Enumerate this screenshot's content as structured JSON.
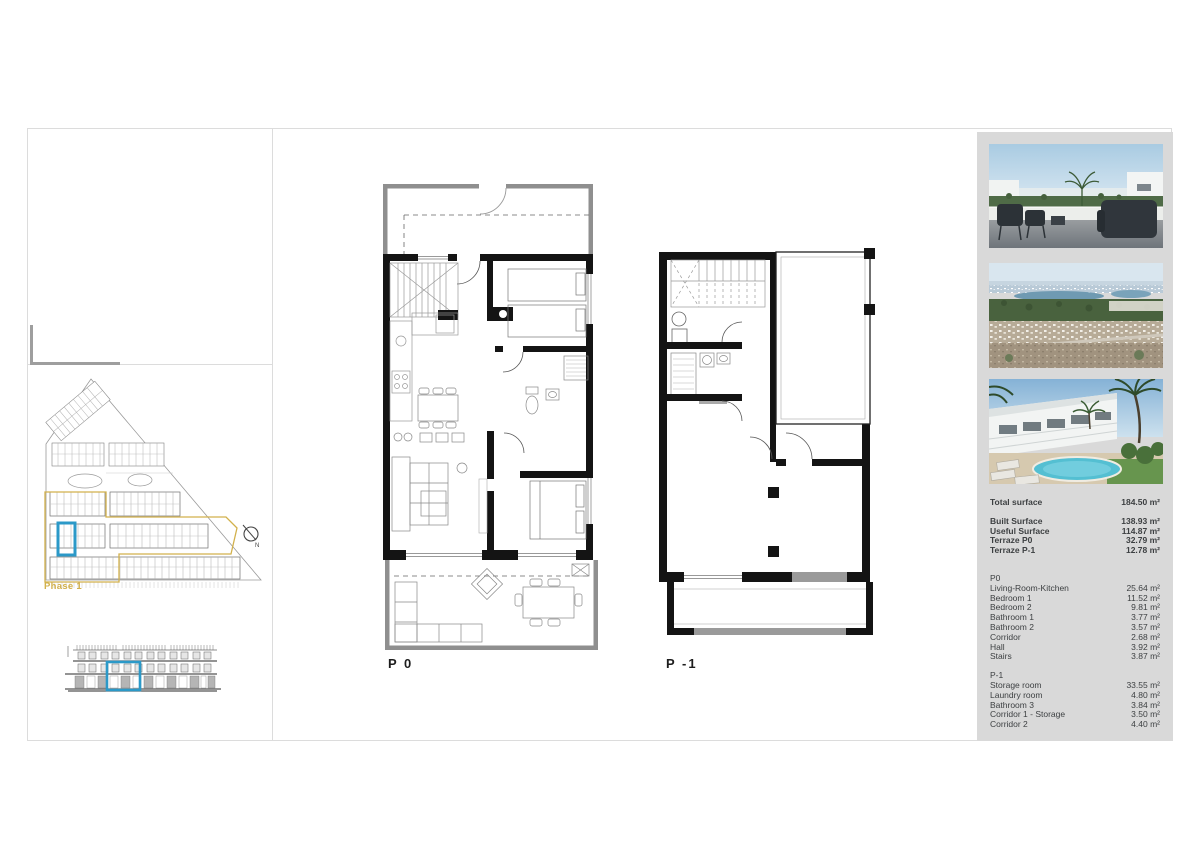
{
  "site_plan": {
    "phase_label": "Phase 1",
    "north_label": "N"
  },
  "floor_plans": {
    "p0_label": "P 0",
    "p1_label": "P -1"
  },
  "summary": {
    "total": {
      "label": "Total surface",
      "value": "184.50 m²"
    },
    "surfaces": [
      {
        "label": "Built Surface",
        "value": "138.93 m²"
      },
      {
        "label": "Useful Surface",
        "value": "114.87 m²"
      },
      {
        "label": "Terraze P0",
        "value": "32.79 m²"
      },
      {
        "label": "Terraze P-1",
        "value": "12.78 m²"
      }
    ],
    "p0_section": {
      "header": "P0",
      "rooms": [
        {
          "label": "Living-Room-Kitchen",
          "value": "25.64 m²"
        },
        {
          "label": "Bedroom 1",
          "value": "11.52 m²"
        },
        {
          "label": "Bedroom 2",
          "value": "9.81 m²"
        },
        {
          "label": "Bathroom 1",
          "value": "3.77 m²"
        },
        {
          "label": "Bathroom 2",
          "value": "3.57 m²"
        },
        {
          "label": "Corridor",
          "value": "2.68 m²"
        },
        {
          "label": "Hall",
          "value": "3.92 m²"
        },
        {
          "label": "Stairs",
          "value": "3.87 m²"
        }
      ]
    },
    "p1_section": {
      "header": "P-1",
      "rooms": [
        {
          "label": "Storage room",
          "value": "33.55 m²"
        },
        {
          "label": "Laundry room",
          "value": "4.80 m²"
        },
        {
          "label": "Bathroom 3",
          "value": "3.84 m²"
        },
        {
          "label": "Corridor 1 - Storage",
          "value": "3.50 m²"
        },
        {
          "label": "Corridor 2",
          "value": "4.40 m²"
        }
      ]
    }
  },
  "colors": {
    "accent_blue": "#2b99c8",
    "accent_yellow": "#d2b14c",
    "panel_gray": "#d9d9d9",
    "wall_black": "#141414"
  },
  "photos": [
    {
      "name": "roof-terrace-view"
    },
    {
      "name": "aerial-coastline-view"
    },
    {
      "name": "residential-pool-view"
    }
  ]
}
